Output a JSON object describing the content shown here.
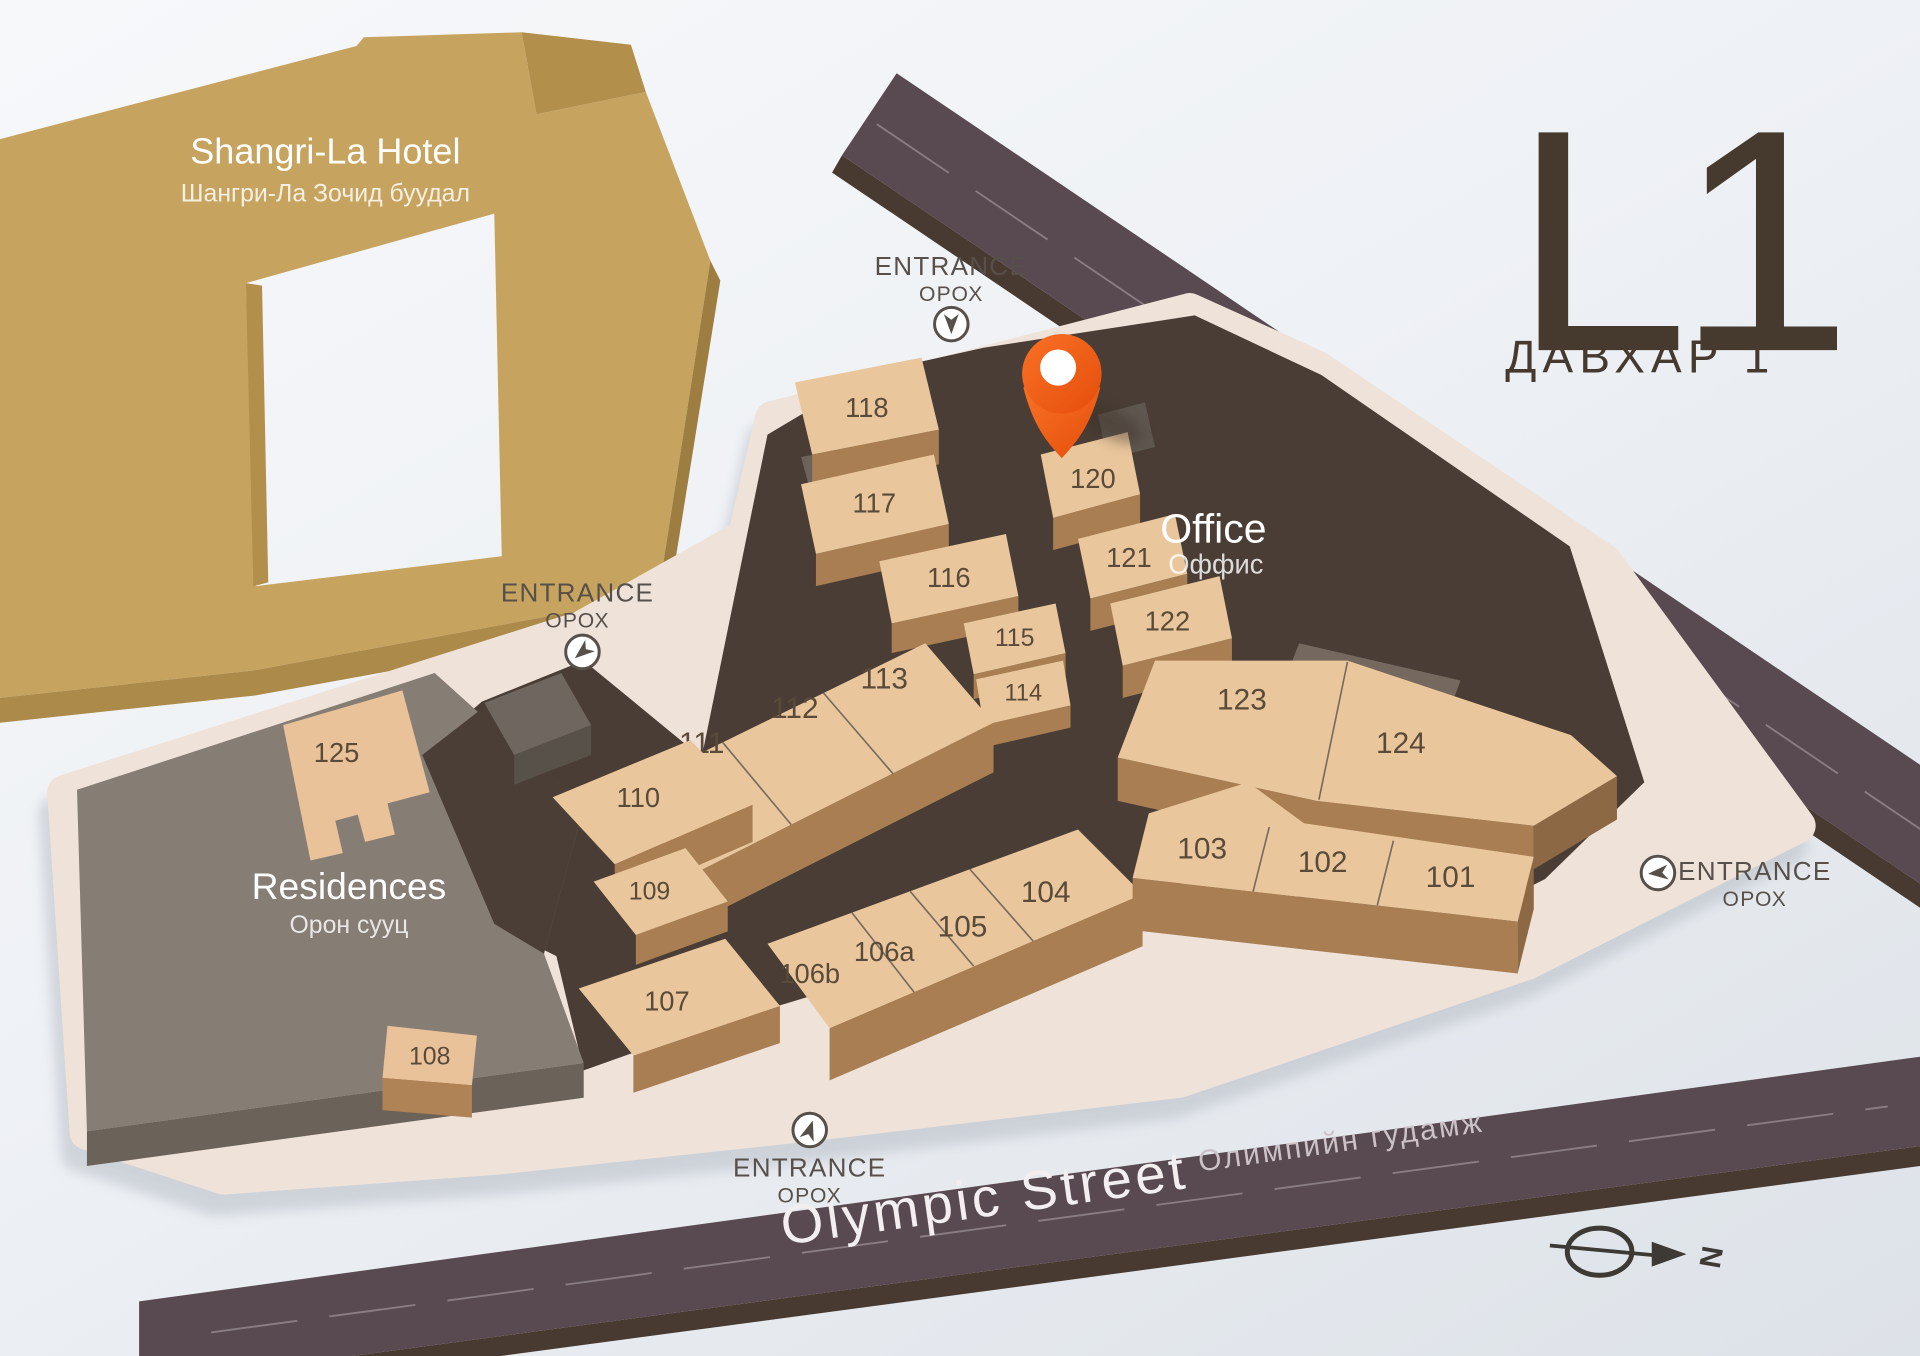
{
  "level": {
    "code": "L1",
    "name_mn": "ДАВХАР 1"
  },
  "hotel": {
    "name": "Shangri-La Hotel",
    "name_mn": "Шангри-Ла Зочид буудал"
  },
  "areas": {
    "residences": {
      "name": "Residences",
      "name_mn": "Орон сууц"
    },
    "office": {
      "name": "Office",
      "name_mn": "Оффис"
    }
  },
  "streets": {
    "genden": {
      "name": "Genden Street",
      "name_mn": "Гэндэнгийн гудамж"
    },
    "olympic": {
      "name": "Olympic Street",
      "name_mn": "Олимпийн гудамж"
    }
  },
  "entrance": {
    "label": "ENTRANCE",
    "label_mn": "ОРОХ"
  },
  "marker": {
    "at_unit": "120"
  },
  "compass": {
    "north": "N"
  },
  "units": [
    {
      "id": "101"
    },
    {
      "id": "102"
    },
    {
      "id": "103"
    },
    {
      "id": "104"
    },
    {
      "id": "105"
    },
    {
      "id": "106a"
    },
    {
      "id": "106b"
    },
    {
      "id": "107"
    },
    {
      "id": "108"
    },
    {
      "id": "109"
    },
    {
      "id": "110"
    },
    {
      "id": "111"
    },
    {
      "id": "112"
    },
    {
      "id": "113"
    },
    {
      "id": "114"
    },
    {
      "id": "115"
    },
    {
      "id": "116"
    },
    {
      "id": "117"
    },
    {
      "id": "118"
    },
    {
      "id": "120"
    },
    {
      "id": "121"
    },
    {
      "id": "122"
    },
    {
      "id": "123"
    },
    {
      "id": "124"
    },
    {
      "id": "125"
    }
  ],
  "colors": {
    "pin_orange": "#F1571A",
    "hotel_gold": "#C6A45F",
    "street_dark": "#584A50",
    "unit_tan": "#E9C69C",
    "unit_front_brown": "#A87E52",
    "floor_dark": "#493D35",
    "residences_gray": "#867D74",
    "base_beige": "#EFE2D9",
    "level_text": "#463A2F"
  }
}
